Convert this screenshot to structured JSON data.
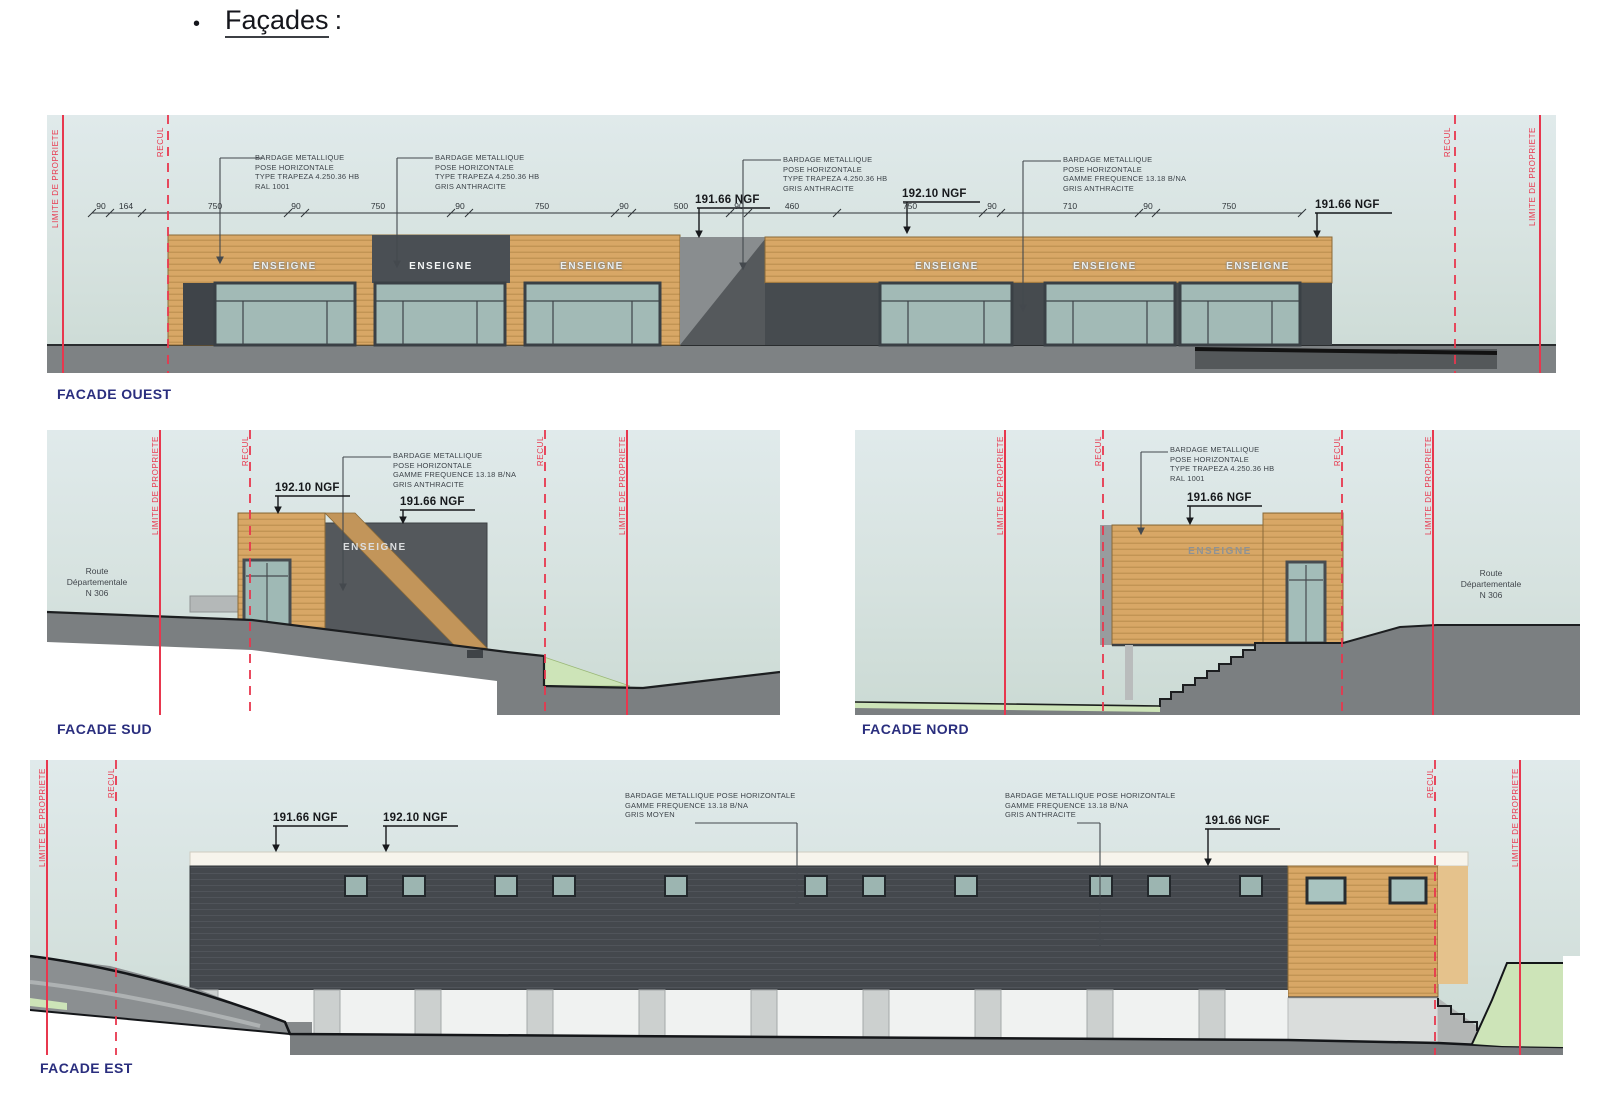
{
  "page": {
    "bullet": "•",
    "heading_word": "Façades",
    "heading_colon": ":"
  },
  "labels": {
    "limite": "LIMITE DE PROPRIETE",
    "recul": "RECUL",
    "enseigne": "ENSEIGNE",
    "route1": "Route",
    "route2": "Départementale",
    "route3": "N 306"
  },
  "ngf": {
    "n191": "191.66 NGF",
    "n192": "192.10 NGF"
  },
  "annotations": {
    "trapeza_ral": [
      "BARDAGE METALLIQUE",
      "POSE HORIZONTALE",
      "TYPE TRAPEZA 4.250.36 HB",
      "RAL 1001"
    ],
    "trapeza_anthracite": [
      "BARDAGE METALLIQUE",
      "POSE HORIZONTALE",
      "TYPE TRAPEZA 4.250.36 HB",
      "GRIS ANTHRACITE"
    ],
    "frequence_anthracite": [
      "BARDAGE METALLIQUE",
      "POSE HORIZONTALE",
      "GAMME FREQUENCE 13.18 B/NA",
      "GRIS ANTHRACITE"
    ],
    "est_left": [
      "BARDAGE METALLIQUE POSE HORIZONTALE",
      "GAMME FREQUENCE 13.18 B/NA",
      "GRIS MOYEN"
    ],
    "est_right": [
      "BARDAGE METALLIQUE POSE HORIZONTALE",
      "GAMME FREQUENCE 13.18 B/NA",
      "GRIS ANTHRACITE"
    ]
  },
  "facades": {
    "ouest": {
      "title": "FACADE OUEST",
      "dims": [
        "90",
        "164",
        "750",
        "90",
        "750",
        "90",
        "750",
        "90",
        "500",
        "90",
        "460",
        "750",
        "90",
        "710",
        "90",
        "750"
      ]
    },
    "sud": {
      "title": "FACADE SUD"
    },
    "nord": {
      "title": "FACADE NORD"
    },
    "est": {
      "title": "FACADE EST"
    }
  },
  "colors": {
    "red_line": "#e8374e",
    "wood": "#d8a766",
    "anthracite": "#44484d",
    "glazing": "#a2bab6",
    "title_navy": "#2a2e7e"
  }
}
